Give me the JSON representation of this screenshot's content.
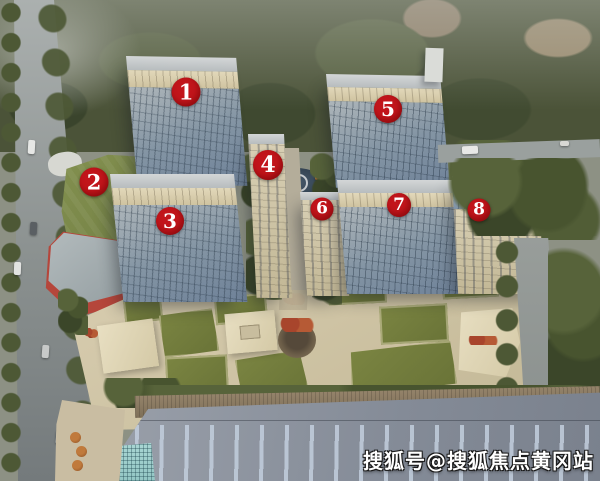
{
  "markers": [
    {
      "label": "1",
      "x": 186,
      "y": 92,
      "d": 29
    },
    {
      "label": "2",
      "x": 94,
      "y": 182,
      "d": 29
    },
    {
      "label": "3",
      "x": 170,
      "y": 221,
      "d": 28
    },
    {
      "label": "4",
      "x": 268,
      "y": 165,
      "d": 30
    },
    {
      "label": "5",
      "x": 388,
      "y": 109,
      "d": 28
    },
    {
      "label": "6",
      "x": 322,
      "y": 209,
      "d": 23
    },
    {
      "label": "7",
      "x": 399,
      "y": 205,
      "d": 24
    },
    {
      "label": "8",
      "x": 479,
      "y": 210,
      "d": 23
    }
  ],
  "watermark": {
    "text": "搜狐号@搜狐焦点黄冈站"
  },
  "colors": {
    "marker_bg": "#c2151b",
    "marker_text": "#ffffff",
    "watermark_text": "#ffffff",
    "watermark_outline": "#191919"
  }
}
